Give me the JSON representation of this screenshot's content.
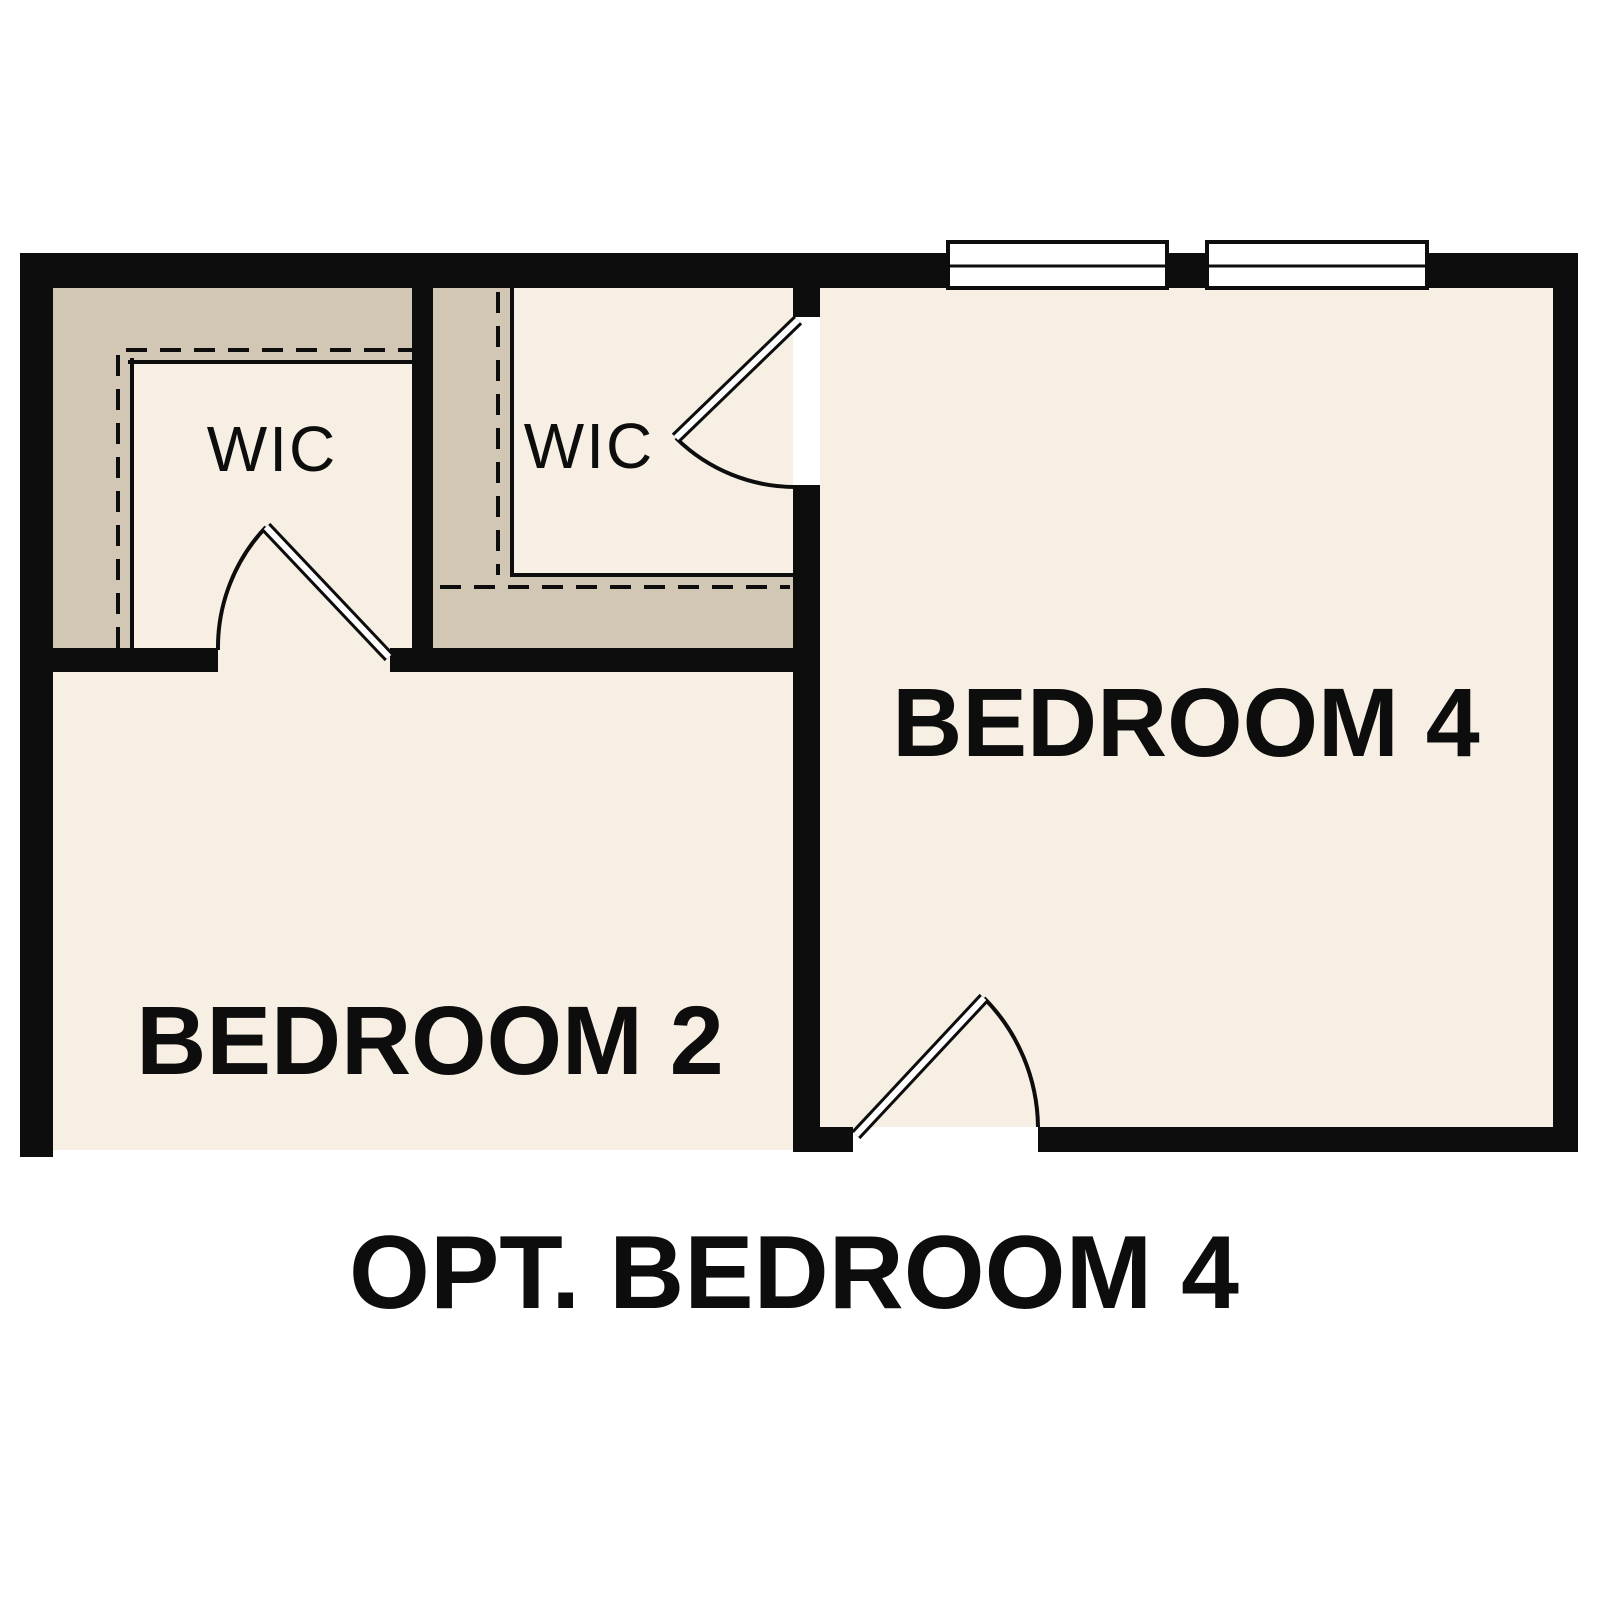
{
  "title": {
    "text": "OPT. BEDROOM 4"
  },
  "rooms": {
    "bedroom_2": {
      "label": "BEDROOM 2"
    },
    "bedroom_4": {
      "label": "BEDROOM 4"
    },
    "wic_left": {
      "label": "WIC"
    },
    "wic_right": {
      "label": "WIC"
    }
  },
  "palette": {
    "background": "#ffffff",
    "wall": "#0d0d0d",
    "room_fill": "#f7efe3",
    "closet_fill": "#d2c7b4",
    "window_fill": "#ffffff"
  }
}
